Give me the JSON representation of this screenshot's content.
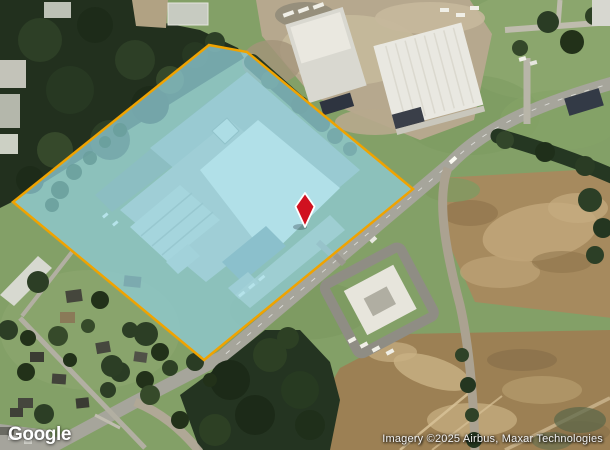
{
  "meta": {
    "width": 610,
    "height": 450,
    "view_type": "satellite"
  },
  "map": {
    "footer": {
      "logo_text": "Google",
      "attribution": "Imagery ©2025 Airbus, Maxar Technologies"
    },
    "parcel_overlay": {
      "fill_color": "rgba(140,215,235,0.58)",
      "outline_color": "#F0A300",
      "outline_width": 2.5,
      "vertices": "209,45 247,52 413,189 204,360 13,202"
    },
    "marker": {
      "icon": "location-marker-icon",
      "color": "#D01120",
      "outline_color": "#FFFFFF",
      "x": 305,
      "y": 210
    }
  }
}
